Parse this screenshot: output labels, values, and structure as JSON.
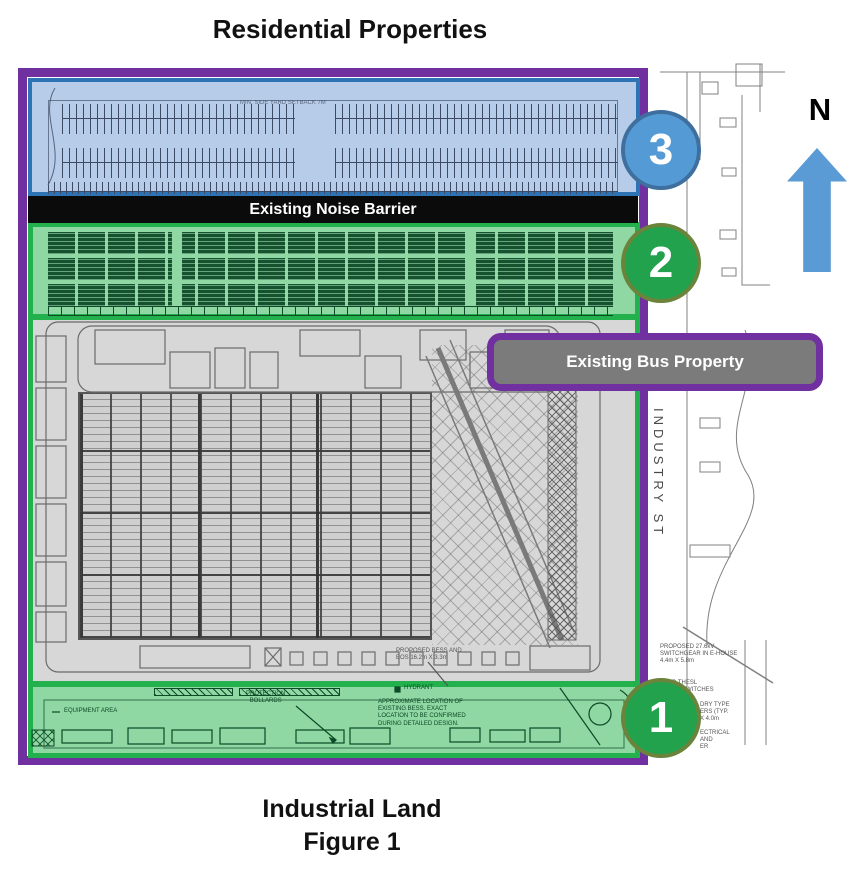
{
  "header": {
    "title": "Residential Properties"
  },
  "footer": {
    "line1": "Industrial Land",
    "line2": "Figure 1"
  },
  "compass": {
    "label": "N"
  },
  "street": {
    "name": "INDUSTRY ST"
  },
  "labels": {
    "noise_barrier": "Existing Noise Barrier",
    "bus_property": "Existing Bus Property"
  },
  "zones": [
    {
      "number": "3",
      "fill": "#549BD5",
      "border": "#3F6F9E",
      "area": "residential parking lot"
    },
    {
      "number": "2",
      "fill": "#22A24D",
      "border": "#6B833B",
      "area": "bus parking yard"
    },
    {
      "number": "1",
      "fill": "#22A24D",
      "border": "#6B833B",
      "area": "equipment area strip"
    }
  ],
  "plan_notes": {
    "setback": "MIN. SIDE YARD SETBACK 7M",
    "bess": "PROPOSED BESS AND\nBOS 16.2m X 3.3m",
    "hydrant": "HYDRANT",
    "equipment_area": "EQUIPMENT AREA",
    "bollards": "PROTECTION\nBOLLARDS",
    "approx_location": "APPROXIMATE LOCATION OF\nEXISTING BESS. EXACT\nLOCATION TO BE CONFIRMED\nDURING DETAILED DESIGN.",
    "switchgear": "PROPOSED 27.6kV\nSWITCHGEAR IN E-HOUSE\n4.4m X 5.8m",
    "thesl": "SED THESL\nNTED SWITCHES\n3m",
    "transformers": "DRY TYPE\nERS (TYP.\nX 4.0m",
    "electrical": "ECTRICAL\nAND\nER"
  },
  "theme": {
    "purple": "#7030A0",
    "bright_green": "#22B14C",
    "zone_green_fill": "#8FD7A3",
    "dark_green": "#0d4a26",
    "blue_zone_fill": "#B6CCE8",
    "blue_zone_border": "#2E74B5",
    "plan_grey": "#D7D7D7",
    "label_grey": "#7b7b7b",
    "arrow_blue": "#5B9BD5",
    "noise_bar_black": "#0b0b0b"
  }
}
